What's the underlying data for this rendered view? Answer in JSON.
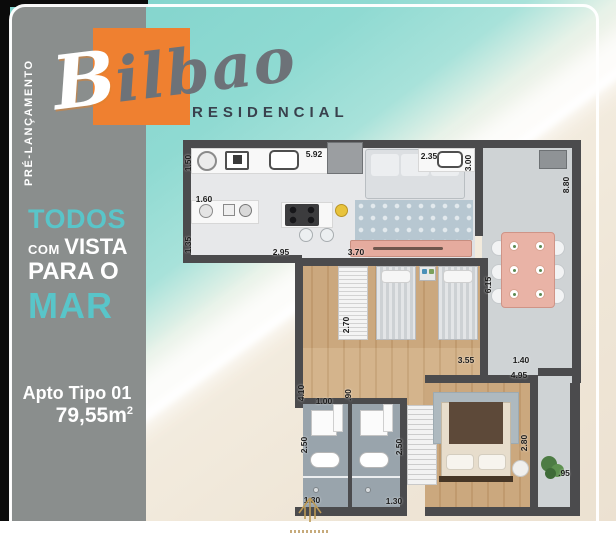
{
  "badge": {
    "label": "PRÉ-LANÇAMENTO"
  },
  "logo": {
    "initial": "B",
    "rest": "ilbao",
    "subtitle": "RESIDENCIAL"
  },
  "headline": {
    "line1": "TODOS",
    "line2_small": "COM",
    "line2_big": "VISTA",
    "line3": "PARA O",
    "line4": "MAR"
  },
  "unit": {
    "title": "Apto Tipo 01",
    "area": "79,55m",
    "area_sup": "2"
  },
  "colors": {
    "accent_teal": "#59c5c9",
    "brand_orange": "#ef8030",
    "panel_gray": "#8a8e8d",
    "wall_gray": "#4b4b4d",
    "water_teal": "#8fdad2",
    "sand": "#f0e7d9"
  },
  "floor_plan": {
    "dimensions": [
      {
        "text": "1.50",
        "x": -8,
        "y": 18,
        "rot": true
      },
      {
        "text": "5.92",
        "x": 118,
        "y": 9,
        "rot": false
      },
      {
        "text": "2.35",
        "x": 233,
        "y": 11,
        "rot": false
      },
      {
        "text": "3.00",
        "x": 272,
        "y": 18,
        "rot": true
      },
      {
        "text": "8.80",
        "x": 370,
        "y": 40,
        "rot": true
      },
      {
        "text": "1.60",
        "x": 8,
        "y": 54,
        "rot": false
      },
      {
        "text": "1.35",
        "x": -8,
        "y": 100,
        "rot": true
      },
      {
        "text": "2.95",
        "x": 85,
        "y": 107,
        "rot": false
      },
      {
        "text": "3.70",
        "x": 160,
        "y": 107,
        "rot": false
      },
      {
        "text": "6.15",
        "x": 292,
        "y": 140,
        "rot": true
      },
      {
        "text": "2.70",
        "x": 150,
        "y": 180,
        "rot": true
      },
      {
        "text": "3.55",
        "x": 270,
        "y": 215,
        "rot": false
      },
      {
        "text": "1.40",
        "x": 325,
        "y": 215,
        "rot": false
      },
      {
        "text": "4.95",
        "x": 323,
        "y": 230,
        "rot": false
      },
      {
        "text": "4.10",
        "x": 105,
        "y": 248,
        "rot": true
      },
      {
        "text": "1.00",
        "x": 128,
        "y": 256,
        "rot": false
      },
      {
        "text": ".90",
        "x": 152,
        "y": 250,
        "rot": true
      },
      {
        "text": "2.50",
        "x": 108,
        "y": 300,
        "rot": true
      },
      {
        "text": "2.50",
        "x": 203,
        "y": 302,
        "rot": true
      },
      {
        "text": "2.80",
        "x": 328,
        "y": 298,
        "rot": true
      },
      {
        "text": "1.30",
        "x": 116,
        "y": 355,
        "rot": false
      },
      {
        "text": "1.30",
        "x": 198,
        "y": 356,
        "rot": false
      },
      {
        "text": ".95",
        "x": 368,
        "y": 328,
        "rot": false
      }
    ]
  }
}
